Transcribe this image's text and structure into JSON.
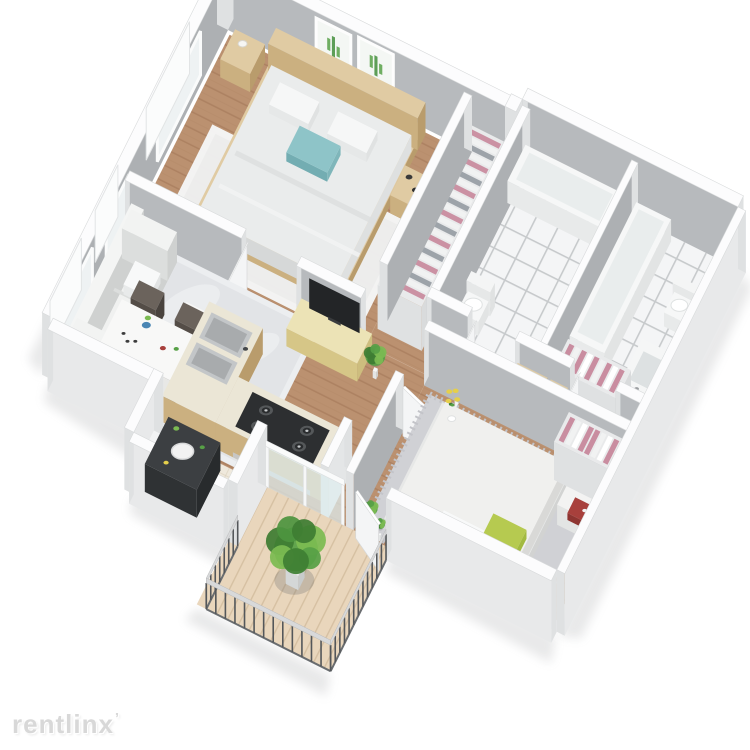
{
  "scene": {
    "description": "3D isometric rendering of a two-bedroom, two-bathroom apartment floor plan with balcony",
    "background": "#ffffff"
  },
  "watermark": {
    "text": "rentlinx",
    "mark": "’",
    "color": "#d8d8d8"
  },
  "colors": {
    "wallFaceSW": "#b7babd",
    "wallFaceSE": "#adb0b3",
    "wallCap": "#fcfcfd",
    "wallCapStroke": "#d8dadb",
    "wallOuter": "#e8e9ea",
    "wallEnd": "#dfe1e2",
    "wallLight": "#f2f3f4",
    "woodBase": "#bb9170",
    "woodLine": "#a27756",
    "tileBase": "#f4f5f6",
    "tileLine": "#c7cacc",
    "deckBase": "#e9d6bc",
    "deckLine": "#d6c0a2",
    "entryBase": "#efe9dd",
    "entryLine": "#ddd4c2",
    "rugLiving": "#e2e4e7",
    "rugLivingLight": "#f0f1f3",
    "rugMaster": "#f0f1f2",
    "rugBed2": "#d0d1d5",
    "rugBed2Edge": "#c3c4c9",
    "sofa": "#f0f1f0",
    "sofaShade": "#dcdedd",
    "sofaDark": "#cfd1d0",
    "woodFurn": "#e0cba3",
    "woodFurnShade": "#cbb080",
    "woodFurnDark": "#b99c6c",
    "consoleWood": "#ece3b6",
    "consoleShade": "#d6c687",
    "white": "#f7f8f8",
    "whiteShade": "#e4e6e6",
    "whiteDark": "#d4d7d7",
    "duvet": "#eaecec",
    "duvetShade": "#d6d8d8",
    "teal": "#8ec4c8",
    "tealShade": "#73adb2",
    "green": "#b6ca50",
    "greenShade": "#98b03a",
    "plant": "#57a046",
    "plantDark": "#3e7d33",
    "plantLight": "#7cbb52",
    "clothesPink": "#c98da0",
    "clothesGray": "#9aa0a6",
    "tv": "#232527",
    "stove": "#2d2f31",
    "burner": "#55585a",
    "silver": "#c6c9cb",
    "sinkSteel": "#c3c6c8",
    "sinkInner": "#a8abad",
    "chair": "#6b635c",
    "chairShade": "#544d47",
    "railPost": "#54575a",
    "railTop": "#d8d9da",
    "red": "#a8403c",
    "blue": "#4a86b4",
    "yellow": "#e5cf4b",
    "glass": "#dfeef0",
    "shadow": "rgba(125,130,133,0.32)"
  },
  "rooms": [
    {
      "name": "master-bedroom",
      "floor": "hardwood",
      "furniture": [
        "double-bed-white-bedding",
        "teal-accent-pillow",
        "wood-headboard",
        "nightstand-with-lamp",
        "nightstand-with-decor",
        "white-area-rug",
        "two-cactus-wall-prints",
        "window"
      ]
    },
    {
      "name": "wardrobe-nook",
      "floor": "hardwood",
      "furniture": [
        "open-closet-hanging-clothes"
      ]
    },
    {
      "name": "bathroom-1",
      "floor": "white-tile",
      "furniture": [
        "bathtub",
        "toilet",
        "open-door"
      ]
    },
    {
      "name": "bathroom-2",
      "floor": "white-tile",
      "furniture": [
        "bathtub",
        "toilet",
        "vanity-sink",
        "open-closet-hanging-clothes",
        "open-door"
      ]
    },
    {
      "name": "hallway",
      "floor": "hardwood",
      "furniture": [
        "wood-shelving-with-towels"
      ]
    },
    {
      "name": "living-room",
      "floor": "hardwood",
      "furniture": [
        "white-sofa",
        "throw-pillow",
        "gray-area-rug",
        "white-coffee-table-with-plant",
        "tv-console",
        "flat-screen-tv",
        "potted-plant",
        "windows"
      ]
    },
    {
      "name": "dining-area",
      "floor": "hardwood",
      "furniture": [
        "white-dining-table",
        "four-dark-chairs",
        "table-decor"
      ]
    },
    {
      "name": "kitchen",
      "floor": "hardwood",
      "furniture": [
        "l-shaped-counter",
        "double-sink",
        "four-burner-gas-cooktop"
      ]
    },
    {
      "name": "entry",
      "floor": "beige-tile",
      "furniture": [
        "dark-utility-cabinet-round-lid"
      ]
    },
    {
      "name": "bedroom-2",
      "floor": "hardwood",
      "furniture": [
        "double-bed-white-bedding",
        "green-accent-pillow",
        "yellow-flowers",
        "white-nightstand-red-box",
        "gray-shag-rug",
        "open-closet-hanging-clothes",
        "potted-plants"
      ]
    },
    {
      "name": "balcony",
      "floor": "wood-deck",
      "furniture": [
        "metal-railing",
        "large-potted-plant",
        "glass-slider-door"
      ]
    }
  ]
}
